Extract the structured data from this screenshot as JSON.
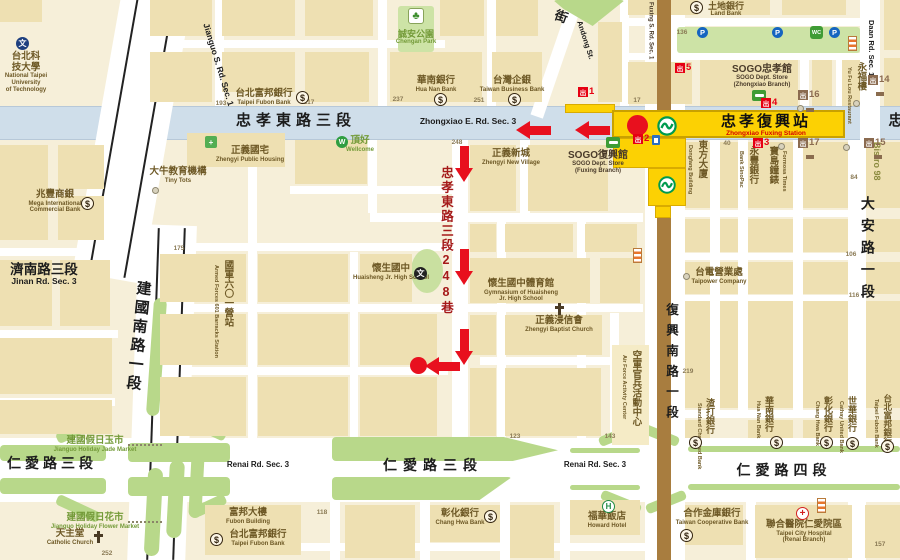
{
  "station": {
    "name_zh": "忠孝復興站",
    "name_en": "Zhongxiao Fuxing Station"
  },
  "colors": {
    "k": "#1c1c1c",
    "br": "#6d5825",
    "g": "#739a38",
    "dr": "#a51a1a",
    "nv": "#4a3b2a",
    "ol": "#8a8a3e",
    "route_red": "#e8101e",
    "exit_red": "#e60012",
    "exit_brown": "#8b6b50",
    "yellow": "#fcd103",
    "mrt_green": "#009a4e"
  },
  "road_labels": [
    {
      "n": "zhongxiao-rd-label-zh",
      "zh": "忠孝東路三段",
      "x": 296,
      "y": 113,
      "s": 15,
      "ls": 5,
      "c": "k"
    },
    {
      "n": "zhongxiao-rd-label-en",
      "zh": "Zhongxiao E. Rd. Sec. 3",
      "x": 468,
      "y": 117,
      "s": 8.5,
      "c": "k"
    },
    {
      "n": "zhongxiao-rd-partial",
      "zh": "忠",
      "x": 896,
      "y": 113,
      "s": 15,
      "c": "k"
    },
    {
      "n": "renai3-label-zh-left",
      "zh": "仁愛路三段",
      "x": 52,
      "y": 456,
      "s": 14,
      "ls": 4,
      "c": "k"
    },
    {
      "n": "renai3-label-en-left",
      "zh": "Renai Rd. Sec. 3",
      "x": 258,
      "y": 461,
      "s": 8,
      "c": "k"
    },
    {
      "n": "renai3-label-zh-center",
      "zh": "仁愛路三段",
      "x": 433,
      "y": 458,
      "s": 14,
      "ls": 6,
      "c": "k"
    },
    {
      "n": "renai3-label-en-right",
      "zh": "Renai Rd. Sec. 3",
      "x": 595,
      "y": 461,
      "s": 8,
      "c": "k"
    },
    {
      "n": "renai4-label-zh",
      "zh": "仁愛路四段",
      "x": 784,
      "y": 463,
      "s": 14,
      "ls": 5,
      "c": "k"
    },
    {
      "n": "jianguo-rd-label-en",
      "zh": "Jianguo S. Rd. Sec. 1",
      "x": 218,
      "y": 60,
      "s": 8.5,
      "rot": 73,
      "c": "k"
    },
    {
      "n": "jianguo-rd-label-zh",
      "zh": "建國南路一段",
      "x": 137,
      "y": 280,
      "s": 15,
      "v": 1,
      "rot": 6,
      "ls": 4,
      "c": "k"
    },
    {
      "n": "jinan-rd-label",
      "zh": "濟南路三段",
      "en": "Jinan Rd. Sec. 3",
      "x": 44,
      "y": 262,
      "s": 13.5,
      "es": 8.5,
      "c": "k",
      "ec": "k"
    },
    {
      "n": "fuxing-rd-label-zh",
      "zh": "復興南路一段",
      "x": 671,
      "y": 303,
      "s": 12.5,
      "v": 1,
      "ls": 8,
      "c": "k"
    },
    {
      "n": "fuxing-rd-label-en",
      "zh": "Fuxing S. Rd. Sec. 1",
      "x": 650,
      "y": 2,
      "s": 6,
      "vsd": 1,
      "c": "nv"
    },
    {
      "n": "lane248-label",
      "zh": "忠孝東路三段248巷",
      "x": 446,
      "y": 166,
      "s": 12.5,
      "v": 1,
      "ls": 2,
      "c": "dr"
    },
    {
      "n": "daan-rd-label-en-top",
      "zh": "Daan Rd. Sec. 1",
      "x": 871,
      "y": 20,
      "s": 7.5,
      "vsd": 1,
      "c": "k"
    },
    {
      "n": "daan-rd-label-zh",
      "zh": "大安路一段",
      "x": 867,
      "y": 196,
      "s": 14,
      "v": 1,
      "ls": 8,
      "c": "k"
    },
    {
      "n": "andong-st-char",
      "zh": "街",
      "x": 561,
      "y": 10,
      "s": 13,
      "rot": 20,
      "c": "k"
    },
    {
      "n": "andong-st-label-en",
      "zh": "Andong St.",
      "x": 585,
      "y": 36,
      "s": 7.5,
      "rot": 72,
      "c": "k"
    }
  ],
  "poi_labels": [
    {
      "n": "ntut",
      "zh": "台北科技大學",
      "zl": "台北科/技大學",
      "en": "National Taipei/University/of Technology",
      "x": 26,
      "y": 52
    },
    {
      "n": "mega-bank",
      "zh": "兆豐商銀",
      "en": "Mega International/Commercial Bank",
      "x": 55,
      "y": 190
    },
    {
      "n": "tiny-tots",
      "zh": "大牛教育機構",
      "en": "Tiny Tots",
      "x": 178,
      "y": 167
    },
    {
      "n": "zhengyi-housing",
      "zh": "正義國宅",
      "en": "Zhengyi Public Housing",
      "x": 250,
      "y": 146
    },
    {
      "n": "fubon-bank-top",
      "zh": "台北富邦銀行",
      "en": "Taipei Fubon Bank",
      "x": 264,
      "y": 89
    },
    {
      "n": "huanan-bank-top",
      "zh": "華南銀行",
      "en": "Hua Nan Bank",
      "x": 436,
      "y": 76
    },
    {
      "n": "taiwan-business-bank",
      "zh": "台灣企銀",
      "en": "Taiwan Business Bank",
      "x": 512,
      "y": 76
    },
    {
      "n": "chengan-park",
      "zh": "誠安公園",
      "en": "Chengan Park",
      "x": 416,
      "y": 29,
      "s": 9,
      "c": "g",
      "ec": "g"
    },
    {
      "n": "land-bank",
      "zh": "土地銀行",
      "en": "Land Bank",
      "x": 726,
      "y": 1,
      "s": 9
    },
    {
      "n": "wellcome",
      "zh": "頂好",
      "en": "Wellcome",
      "x": 360,
      "y": 136,
      "s": 9.5,
      "c": "g",
      "ec": "g"
    },
    {
      "n": "zhengyi-new-village",
      "zh": "正義新城",
      "en": "Zhengyi New Village",
      "x": 511,
      "y": 149
    },
    {
      "n": "sogo-fuxing",
      "zh": "SOGO復興館",
      "en": "SOGO Dept. Store/(Fuxing Branch)",
      "x": 598,
      "y": 150,
      "s": 10,
      "c": "nv"
    },
    {
      "n": "sogo-zhongxiao",
      "zh": "SOGO忠孝館",
      "en": "SOGO Dept. Store/(Zhongxiao Branch)",
      "x": 762,
      "y": 64,
      "s": 10,
      "c": "nv"
    },
    {
      "n": "yongfulou",
      "zh": "永福樓",
      "x": 860,
      "y": 62,
      "s": 9.5,
      "v": 1,
      "enV": "Yu Fu Lou Restaurant",
      "enSide": "l"
    },
    {
      "n": "dongfang-building",
      "zh": "東方大廈",
      "x": 701,
      "y": 140,
      "s": 9.5,
      "v": 1,
      "enV": "Dongfang Building",
      "enSide": "l"
    },
    {
      "n": "sinopac-bank",
      "zh": "永豐銀行",
      "x": 752,
      "y": 146,
      "s": 9.5,
      "v": 1,
      "enV": "Bank SinoPac",
      "enSide": "l"
    },
    {
      "n": "formosa-times",
      "zh": "寶島鐘錶",
      "x": 772,
      "y": 146,
      "s": 9.5,
      "v": 1,
      "enV": "Formosa Times",
      "enSide": "r"
    },
    {
      "n": "bistro-98",
      "zh": "Bistro 98",
      "x": 877,
      "y": 142,
      "s": 9,
      "vsd": 1,
      "c": "ol"
    },
    {
      "n": "taipower",
      "zh": "台電營業處",
      "en": "Taipower Company",
      "x": 719,
      "y": 268
    },
    {
      "n": "huaisheng-school",
      "zh": "懷生國中",
      "en": "Huaisheng Jr. High School",
      "x": 391,
      "y": 264
    },
    {
      "n": "huaisheng-gym",
      "zh": "懷生國中體育館",
      "en": "Gymnasium of Huaisheng/Jr. High School",
      "x": 521,
      "y": 279
    },
    {
      "n": "zhengyi-baptist-church",
      "zh": "正義浸信會",
      "en": "Zhengyi Baptist Church",
      "x": 559,
      "y": 316
    },
    {
      "n": "armed-forces-601",
      "zh": "國軍六〇一營站",
      "x": 227,
      "y": 260,
      "s": 9.5,
      "v": 1,
      "enV": "Armed Forces 601 Barracks Station",
      "enSide": "l"
    },
    {
      "n": "air-force-activity-center",
      "zh": "空軍官兵活動中心",
      "x": 635,
      "y": 350,
      "s": 9.5,
      "v": 1,
      "enV": "Air Force Activity Center",
      "enSide": "l"
    },
    {
      "n": "jade-market",
      "zh": "建國假日玉市",
      "en": "Jianguo Holiday Jade Market",
      "x": 95,
      "y": 436,
      "c": "g",
      "ec": "g"
    },
    {
      "n": "flower-market",
      "zh": "建國假日花市",
      "en": "Jianguo Holiday Flower Market",
      "x": 95,
      "y": 513,
      "c": "g",
      "ec": "g"
    },
    {
      "n": "catholic-church",
      "zh": "天主堂",
      "en": "Catholic Church",
      "x": 70,
      "y": 529
    },
    {
      "n": "fubon-building",
      "zh": "富邦大樓",
      "en": "Fubon Building",
      "x": 248,
      "y": 508
    },
    {
      "n": "fubon-bank-bottom",
      "zh": "台北富邦銀行",
      "en": "Taipei Fubon Bank",
      "x": 258,
      "y": 530
    },
    {
      "n": "changhwa-bank-bottom",
      "zh": "彰化銀行",
      "en": "Chang Hwa Bank",
      "x": 460,
      "y": 509
    },
    {
      "n": "howard-hotel",
      "zh": "福華飯店",
      "en": "Howard Hotel",
      "x": 607,
      "y": 512
    },
    {
      "n": "coop-bank",
      "zh": "合作金庫銀行",
      "en": "Taiwan Cooperative Bank",
      "x": 712,
      "y": 509
    },
    {
      "n": "hospital-renai",
      "zh": "聯合醫院仁愛院區",
      "en": "Taipei City Hospital/(Renai Branch)",
      "x": 804,
      "y": 520
    },
    {
      "n": "huanan-bank-vert",
      "zh": "華南銀行",
      "x": 769,
      "y": 396,
      "s": 9,
      "v": 1,
      "enV": "Hua Nan Bank",
      "enSide": "l"
    },
    {
      "n": "changhwa-bank-vert",
      "zh": "彰化銀行",
      "x": 828,
      "y": 396,
      "s": 9,
      "v": 1,
      "enV": "Chang Hwa Bank",
      "enSide": "l"
    },
    {
      "n": "cathay-bank-vert",
      "zh": "世華銀行",
      "x": 852,
      "y": 396,
      "s": 9,
      "v": 1,
      "enV": "Cathay United Bank",
      "enSide": "l"
    },
    {
      "n": "fubon-bank-vert",
      "zh": "台北富邦銀行",
      "x": 887,
      "y": 394,
      "s": 8.5,
      "v": 1,
      "enV": "Taipei Fubon Bank",
      "enSide": "l"
    },
    {
      "n": "standard-chartered",
      "zh": "渣打銀行",
      "x": 710,
      "y": 398,
      "s": 9,
      "v": 1,
      "enV": "Standard Chartered Bank",
      "enSide": "l"
    }
  ],
  "exits": [
    {
      "num": "1",
      "c": "red",
      "x": 578,
      "y": 87
    },
    {
      "num": "2",
      "c": "red",
      "x": 633,
      "y": 134
    },
    {
      "num": "3",
      "c": "red",
      "x": 753,
      "y": 138
    },
    {
      "num": "4",
      "c": "red",
      "x": 761,
      "y": 98
    },
    {
      "num": "5",
      "c": "red",
      "x": 675,
      "y": 63
    },
    {
      "num": "14",
      "c": "brown",
      "x": 868,
      "y": 75
    },
    {
      "num": "15",
      "c": "brown",
      "x": 864,
      "y": 138
    },
    {
      "num": "16",
      "c": "brown",
      "x": 798,
      "y": 90
    },
    {
      "num": "17",
      "c": "brown",
      "x": 798,
      "y": 138
    }
  ],
  "icons": [
    {
      "t": "dollar",
      "x": 81,
      "y": 197
    },
    {
      "t": "dollar",
      "x": 296,
      "y": 91
    },
    {
      "t": "dollar",
      "x": 434,
      "y": 93
    },
    {
      "t": "dollar",
      "x": 508,
      "y": 93
    },
    {
      "t": "dollar",
      "x": 690,
      "y": 1
    },
    {
      "t": "dollar",
      "x": 210,
      "y": 533
    },
    {
      "t": "dollar",
      "x": 484,
      "y": 510
    },
    {
      "t": "dollar",
      "x": 680,
      "y": 529
    },
    {
      "t": "dollar",
      "x": 689,
      "y": 436
    },
    {
      "t": "dollar",
      "x": 770,
      "y": 436
    },
    {
      "t": "dollar",
      "x": 820,
      "y": 436
    },
    {
      "t": "dollar",
      "x": 846,
      "y": 437
    },
    {
      "t": "dollar",
      "x": 881,
      "y": 440
    },
    {
      "t": "p",
      "x": 697,
      "y": 27
    },
    {
      "t": "p",
      "x": 772,
      "y": 27
    },
    {
      "t": "p",
      "x": 829,
      "y": 27
    },
    {
      "t": "toilet",
      "x": 810,
      "y": 26
    },
    {
      "t": "flag",
      "x": 848,
      "y": 36
    },
    {
      "t": "flag",
      "x": 633,
      "y": 248
    },
    {
      "t": "flag",
      "x": 817,
      "y": 498
    },
    {
      "t": "tree",
      "x": 408,
      "y": 8
    },
    {
      "t": "bus",
      "x": 752,
      "y": 90
    },
    {
      "t": "bus",
      "x": 606,
      "y": 137
    },
    {
      "t": "mrt",
      "x": 658,
      "y": 176
    },
    {
      "t": "wen-navy",
      "x": 16,
      "y": 37
    },
    {
      "t": "wen-black",
      "x": 414,
      "y": 267
    },
    {
      "t": "green-sq",
      "x": 205,
      "y": 136
    },
    {
      "t": "wellcome-circ",
      "x": 336,
      "y": 136
    },
    {
      "t": "h-circ",
      "x": 602,
      "y": 500
    },
    {
      "t": "hosp-cross",
      "x": 796,
      "y": 507
    },
    {
      "t": "cross",
      "x": 554,
      "y": 303
    },
    {
      "t": "cross",
      "x": 93,
      "y": 531
    },
    {
      "t": "grey-dot",
      "x": 152,
      "y": 187
    },
    {
      "t": "grey-dot",
      "x": 683,
      "y": 273
    },
    {
      "t": "grey-dot",
      "x": 853,
      "y": 100
    },
    {
      "t": "grey-dot",
      "x": 797,
      "y": 105
    },
    {
      "t": "grey-dot",
      "x": 778,
      "y": 143
    },
    {
      "t": "grey-dot",
      "x": 843,
      "y": 144
    },
    {
      "t": "elevator",
      "x": 652,
      "y": 135
    },
    {
      "t": "tick",
      "x": 806,
      "y": 108
    },
    {
      "t": "tick",
      "x": 876,
      "y": 92
    },
    {
      "t": "tick",
      "x": 806,
      "y": 155
    },
    {
      "t": "tick",
      "x": 874,
      "y": 155
    }
  ],
  "route": {
    "arrows": [
      {
        "d": "left",
        "x": 575,
        "y": 121
      },
      {
        "d": "left",
        "x": 516,
        "y": 121
      },
      {
        "d": "down",
        "x": 455,
        "y": 146
      },
      {
        "d": "down",
        "x": 455,
        "y": 249
      },
      {
        "d": "down",
        "x": 455,
        "y": 329
      },
      {
        "d": "left",
        "x": 425,
        "y": 357
      }
    ],
    "start_marker": {
      "x": 627,
      "y": 113,
      "r": 21
    },
    "dest_marker": {
      "x": 410,
      "y": 357,
      "r": 17
    }
  },
  "numbers": [
    {
      "t": "193",
      "x": 221,
      "y": 100
    },
    {
      "t": "217",
      "x": 309,
      "y": 99
    },
    {
      "t": "237",
      "x": 398,
      "y": 96
    },
    {
      "t": "251",
      "x": 479,
      "y": 97
    },
    {
      "t": "136",
      "x": 682,
      "y": 29
    },
    {
      "t": "17",
      "x": 637,
      "y": 97
    },
    {
      "t": "40",
      "x": 727,
      "y": 140
    },
    {
      "t": "248",
      "x": 457,
      "y": 139
    },
    {
      "t": "175",
      "x": 179,
      "y": 245
    },
    {
      "t": "219",
      "x": 688,
      "y": 368
    },
    {
      "t": "84",
      "x": 854,
      "y": 174
    },
    {
      "t": "106",
      "x": 851,
      "y": 251
    },
    {
      "t": "116",
      "x": 854,
      "y": 292
    },
    {
      "t": "123",
      "x": 515,
      "y": 433
    },
    {
      "t": "143",
      "x": 610,
      "y": 433
    },
    {
      "t": "118",
      "x": 322,
      "y": 509
    },
    {
      "t": "157",
      "x": 880,
      "y": 541
    },
    {
      "t": "252",
      "x": 107,
      "y": 550
    }
  ]
}
